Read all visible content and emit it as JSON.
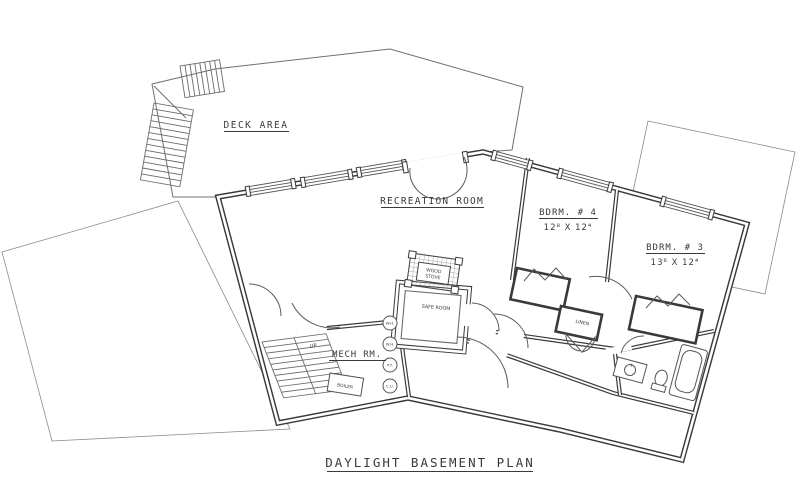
{
  "title": "DAYLIGHT BASEMENT PLAN",
  "rooms": {
    "deck": "DECK AREA",
    "recreation": "RECREATION ROOM",
    "bdrm4": {
      "name": "BDRM. # 4",
      "dims": "12⁸ X 12⁴"
    },
    "bdrm3": {
      "name": "BDRM. # 3",
      "dims": "13⁶ X 12⁴"
    },
    "mech": "MECH RM.",
    "safe_room": "SAFE ROOM",
    "linen": "LINEN"
  },
  "annotations": {
    "wood_stove_line1": "WOOD",
    "wood_stove_line2": "STOVE",
    "boiler": "BOILER",
    "up": "UP",
    "equipment": [
      "W.H.",
      "W.H.",
      "P.T.",
      "C.U."
    ]
  },
  "colors": {
    "wall": "#3a3a3a",
    "thin_line": "#707070",
    "background": "#ffffff"
  }
}
